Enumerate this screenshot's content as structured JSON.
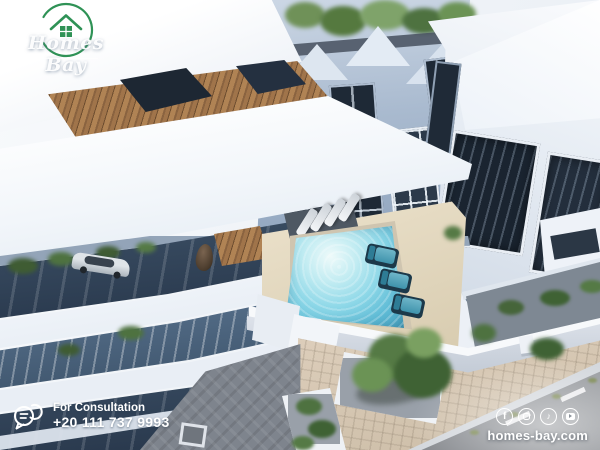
{
  "brand": {
    "name": "Homes Bay",
    "logo_icon": "house-in-circle-arc",
    "green": "#2f9256"
  },
  "contact": {
    "icon": "chat-bubbles",
    "label": "For Consultation",
    "phone": "+20 111 737 9993"
  },
  "footer": {
    "website": "homes-bay.com",
    "social": [
      {
        "name": "facebook",
        "glyph": "f"
      },
      {
        "name": "instagram",
        "glyph": ""
      },
      {
        "name": "tiktok",
        "glyph": "♪"
      },
      {
        "name": "youtube",
        "glyph": ""
      }
    ]
  },
  "scene": {
    "description": "Aerial 3D render of a modern white residential compound with a central courtyard swimming pool, sun loungers, teal lounge chairs, landscaped walkways, trees and a street along the lower right",
    "palette": {
      "facade_white": "#eef2f8",
      "facade_blue_grey": "#a9bacf",
      "glass_dark": "#22303f",
      "wood_cladding": "#a87c50",
      "pool_water": "#7ccfe2",
      "deck_cream": "#e7ddc6",
      "lounge_chair_teal": "#3f93ac",
      "paver_beige": "#d6c7b2",
      "paver_grey": "#7e848d",
      "road_grey": "#8f9296",
      "tree_green": "#557a45"
    }
  }
}
